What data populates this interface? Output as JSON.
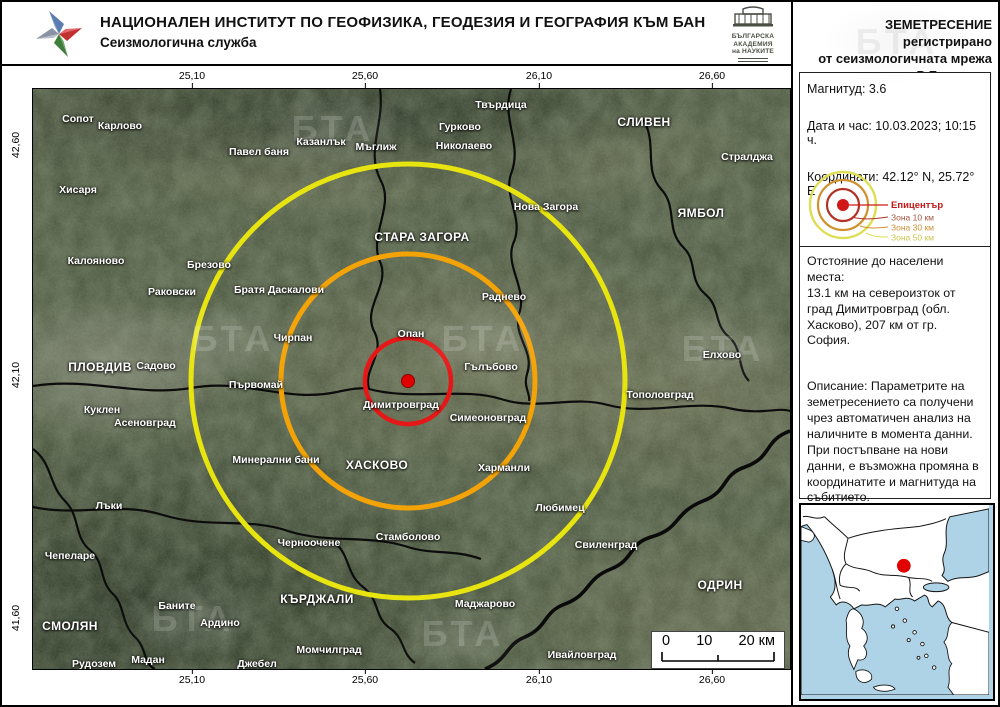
{
  "header": {
    "institute": "НАЦИОНАЛЕН ИНСТИТУТ ПО ГЕОФИЗИКА, ГЕОДЕЗИЯ И ГЕОГРАФИЯ КЪМ БАН",
    "service": "Сеизмологична служба",
    "bas": {
      "l1": "БЪЛГАРСКА",
      "l2": "АКАДЕМИЯ",
      "l3": "на НАУКИТЕ"
    }
  },
  "panel": {
    "heading": {
      "l1": "ЗЕМЕТРЕСЕНИЕ регистрирано",
      "l2": "от сеизмологичната мрежа",
      "l3": "на Р България"
    },
    "info": {
      "magnitude": "Магнитуд: 3.6",
      "datetime": "Дата и час: 10.03.2023; 10:15 ч.",
      "coordinates": "Координати: 42.12° N, 25.72° E"
    },
    "legend": {
      "epicenter": "Епицентър",
      "zone10": "Зона 10 км",
      "zone30": "Зона 30 км",
      "zone50": "Зона 50 км"
    },
    "distance_title": "Отстояние до населени места:",
    "distance_text": "13.1 км на североизток от град Димитровград (обл. Хасково), 207 км от гр. София.",
    "description": "Описание: Параметрите на земетресението са получени чрез автоматичен анализ на наличните в момента данни. При постъпване на нови данни, е възможна промяна в координатите и магнитуда на събитието.",
    "more_info": "Повече информация на",
    "url": "http://ndc.geophys.bas.bg/"
  },
  "map": {
    "watermark_text": "БТА",
    "scalebar": {
      "zero": "0",
      "ten": "10",
      "twenty": "20 км"
    },
    "axis": {
      "top": [
        {
          "t": "25,10",
          "x": 160
        },
        {
          "t": "25,60",
          "x": 333
        },
        {
          "t": "26,10",
          "x": 507
        },
        {
          "t": "26,60",
          "x": 680
        }
      ],
      "bottom": [
        {
          "t": "25,10",
          "x": 160
        },
        {
          "t": "25,60",
          "x": 333
        },
        {
          "t": "26,10",
          "x": 507
        },
        {
          "t": "26,60",
          "x": 680
        }
      ],
      "left": [
        {
          "t": "42,60",
          "y": 57
        },
        {
          "t": "42,10",
          "y": 287
        },
        {
          "t": "41,60",
          "y": 530
        }
      ],
      "right": [
        {
          "t": "42,60",
          "y": 72
        },
        {
          "t": "42,10",
          "y": 304
        },
        {
          "t": "41,60",
          "y": 537
        }
      ]
    },
    "epicenter": {
      "x": 375,
      "y": 292
    },
    "cities": [
      {
        "name": "Сопот",
        "x": 45,
        "y": 30
      },
      {
        "name": "Карлово",
        "x": 87,
        "y": 37
      },
      {
        "name": "Павел баня",
        "x": 226,
        "y": 63
      },
      {
        "name": "Казанлък",
        "x": 288,
        "y": 53
      },
      {
        "name": "Мъглиж",
        "x": 343,
        "y": 58
      },
      {
        "name": "Твърдица",
        "x": 468,
        "y": 16
      },
      {
        "name": "Гурково",
        "x": 427,
        "y": 38
      },
      {
        "name": "Николаево",
        "x": 431,
        "y": 57
      },
      {
        "name": "СЛИВЕН",
        "x": 611,
        "y": 33,
        "major": true
      },
      {
        "name": "Стралджа",
        "x": 714,
        "y": 68
      },
      {
        "name": "Нова Загора",
        "x": 513,
        "y": 118
      },
      {
        "name": "ЯМБОЛ",
        "x": 668,
        "y": 124,
        "major": true
      },
      {
        "name": "СТАРА ЗАГОРА",
        "x": 389,
        "y": 148,
        "major": true
      },
      {
        "name": "Хисаря",
        "x": 45,
        "y": 101
      },
      {
        "name": "Калояново",
        "x": 63,
        "y": 172
      },
      {
        "name": "Брезово",
        "x": 176,
        "y": 176
      },
      {
        "name": "Раковски",
        "x": 139,
        "y": 203
      },
      {
        "name": "Братя Даскалови",
        "x": 246,
        "y": 201
      },
      {
        "name": "Чирпан",
        "x": 260,
        "y": 249
      },
      {
        "name": "Опан",
        "x": 378,
        "y": 245
      },
      {
        "name": "Раднево",
        "x": 471,
        "y": 208
      },
      {
        "name": "ПЛОВДИВ",
        "x": 67,
        "y": 278,
        "major": true
      },
      {
        "name": "Садово",
        "x": 123,
        "y": 277
      },
      {
        "name": "Първомай",
        "x": 223,
        "y": 296
      },
      {
        "name": "Гълъбово",
        "x": 458,
        "y": 278
      },
      {
        "name": "Димитровград",
        "x": 368,
        "y": 316
      },
      {
        "name": "Симеоновград",
        "x": 455,
        "y": 329
      },
      {
        "name": "Тополовград",
        "x": 627,
        "y": 306
      },
      {
        "name": "Елхово",
        "x": 689,
        "y": 266
      },
      {
        "name": "Куклен",
        "x": 69,
        "y": 321
      },
      {
        "name": "Асеновград",
        "x": 112,
        "y": 334
      },
      {
        "name": "Минерални бани",
        "x": 243,
        "y": 371
      },
      {
        "name": "ХАСКОВО",
        "x": 344,
        "y": 376,
        "major": true
      },
      {
        "name": "Харманли",
        "x": 471,
        "y": 379
      },
      {
        "name": "Любимец",
        "x": 527,
        "y": 419
      },
      {
        "name": "Лъки",
        "x": 76,
        "y": 417
      },
      {
        "name": "Чепеларе",
        "x": 37,
        "y": 467
      },
      {
        "name": "Черноочене",
        "x": 276,
        "y": 454
      },
      {
        "name": "Стамболово",
        "x": 375,
        "y": 448
      },
      {
        "name": "Свиленград",
        "x": 573,
        "y": 456
      },
      {
        "name": "КЪРДЖАЛИ",
        "x": 284,
        "y": 510,
        "major": true
      },
      {
        "name": "ОДРИН",
        "x": 687,
        "y": 496,
        "major": true
      },
      {
        "name": "Баните",
        "x": 144,
        "y": 517
      },
      {
        "name": "СМОЛЯН",
        "x": 37,
        "y": 537,
        "major": true
      },
      {
        "name": "Ардино",
        "x": 187,
        "y": 534
      },
      {
        "name": "Маджарово",
        "x": 452,
        "y": 515
      },
      {
        "name": "Момчилград",
        "x": 296,
        "y": 561
      },
      {
        "name": "Мадан",
        "x": 115,
        "y": 571
      },
      {
        "name": "Рудозем",
        "x": 61,
        "y": 575
      },
      {
        "name": "Джебел",
        "x": 224,
        "y": 575
      },
      {
        "name": "Ивайловград",
        "x": 549,
        "y": 566
      }
    ],
    "colors": {
      "zone10": "#e61717",
      "zone30": "#f4a306",
      "zone50": "#e7e410",
      "epicenter_dot": "#e10000",
      "sea": "#aed3e6"
    }
  }
}
